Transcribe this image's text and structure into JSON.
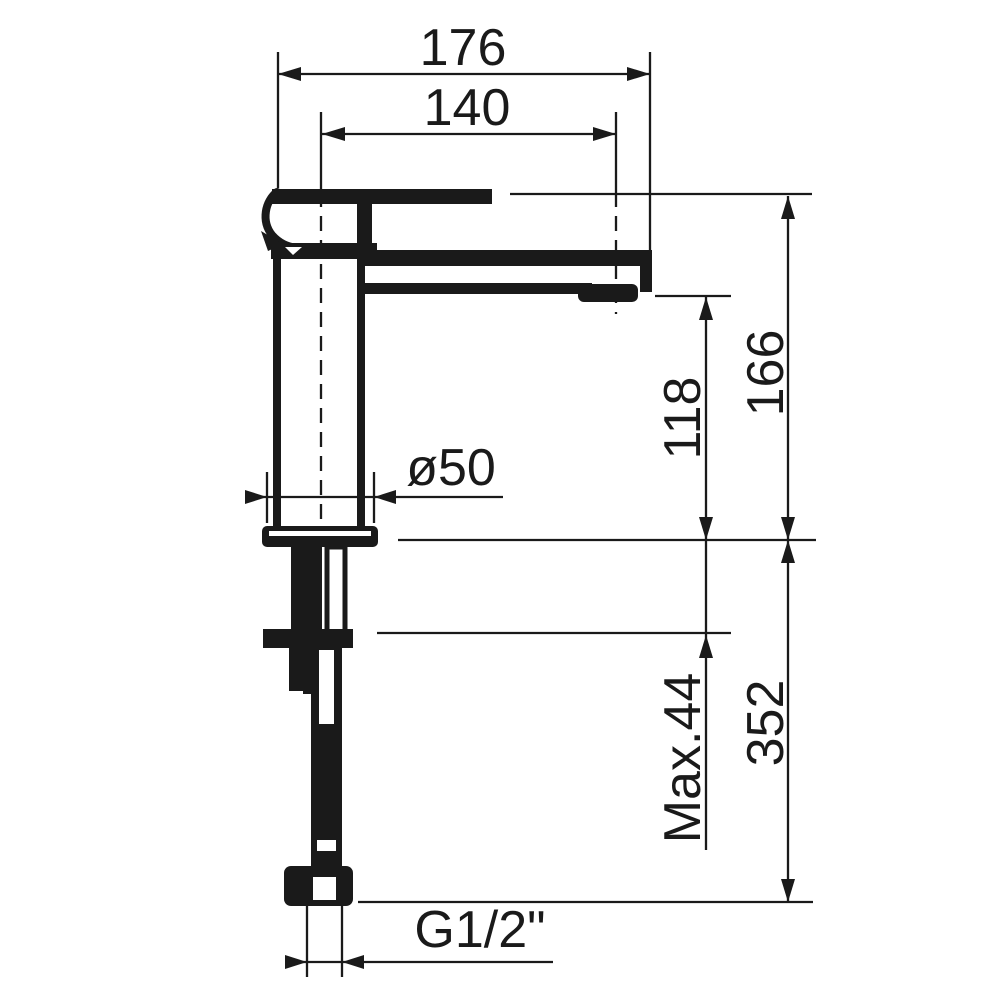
{
  "drawing": {
    "kind": "technical dimension drawing of a single-lever basin mixer tap, side elevation",
    "colors": {
      "ink": "#1a1a1a",
      "paper": "#ffffff"
    },
    "labels": {
      "overall_projection": "176",
      "spout_projection": "140",
      "overall_height": "166",
      "spout_height": "118",
      "base_diameter": "ø50",
      "max_deck_thickness": "Max.44",
      "below_deck_length": "352",
      "connection_thread": "G1/2\""
    }
  }
}
